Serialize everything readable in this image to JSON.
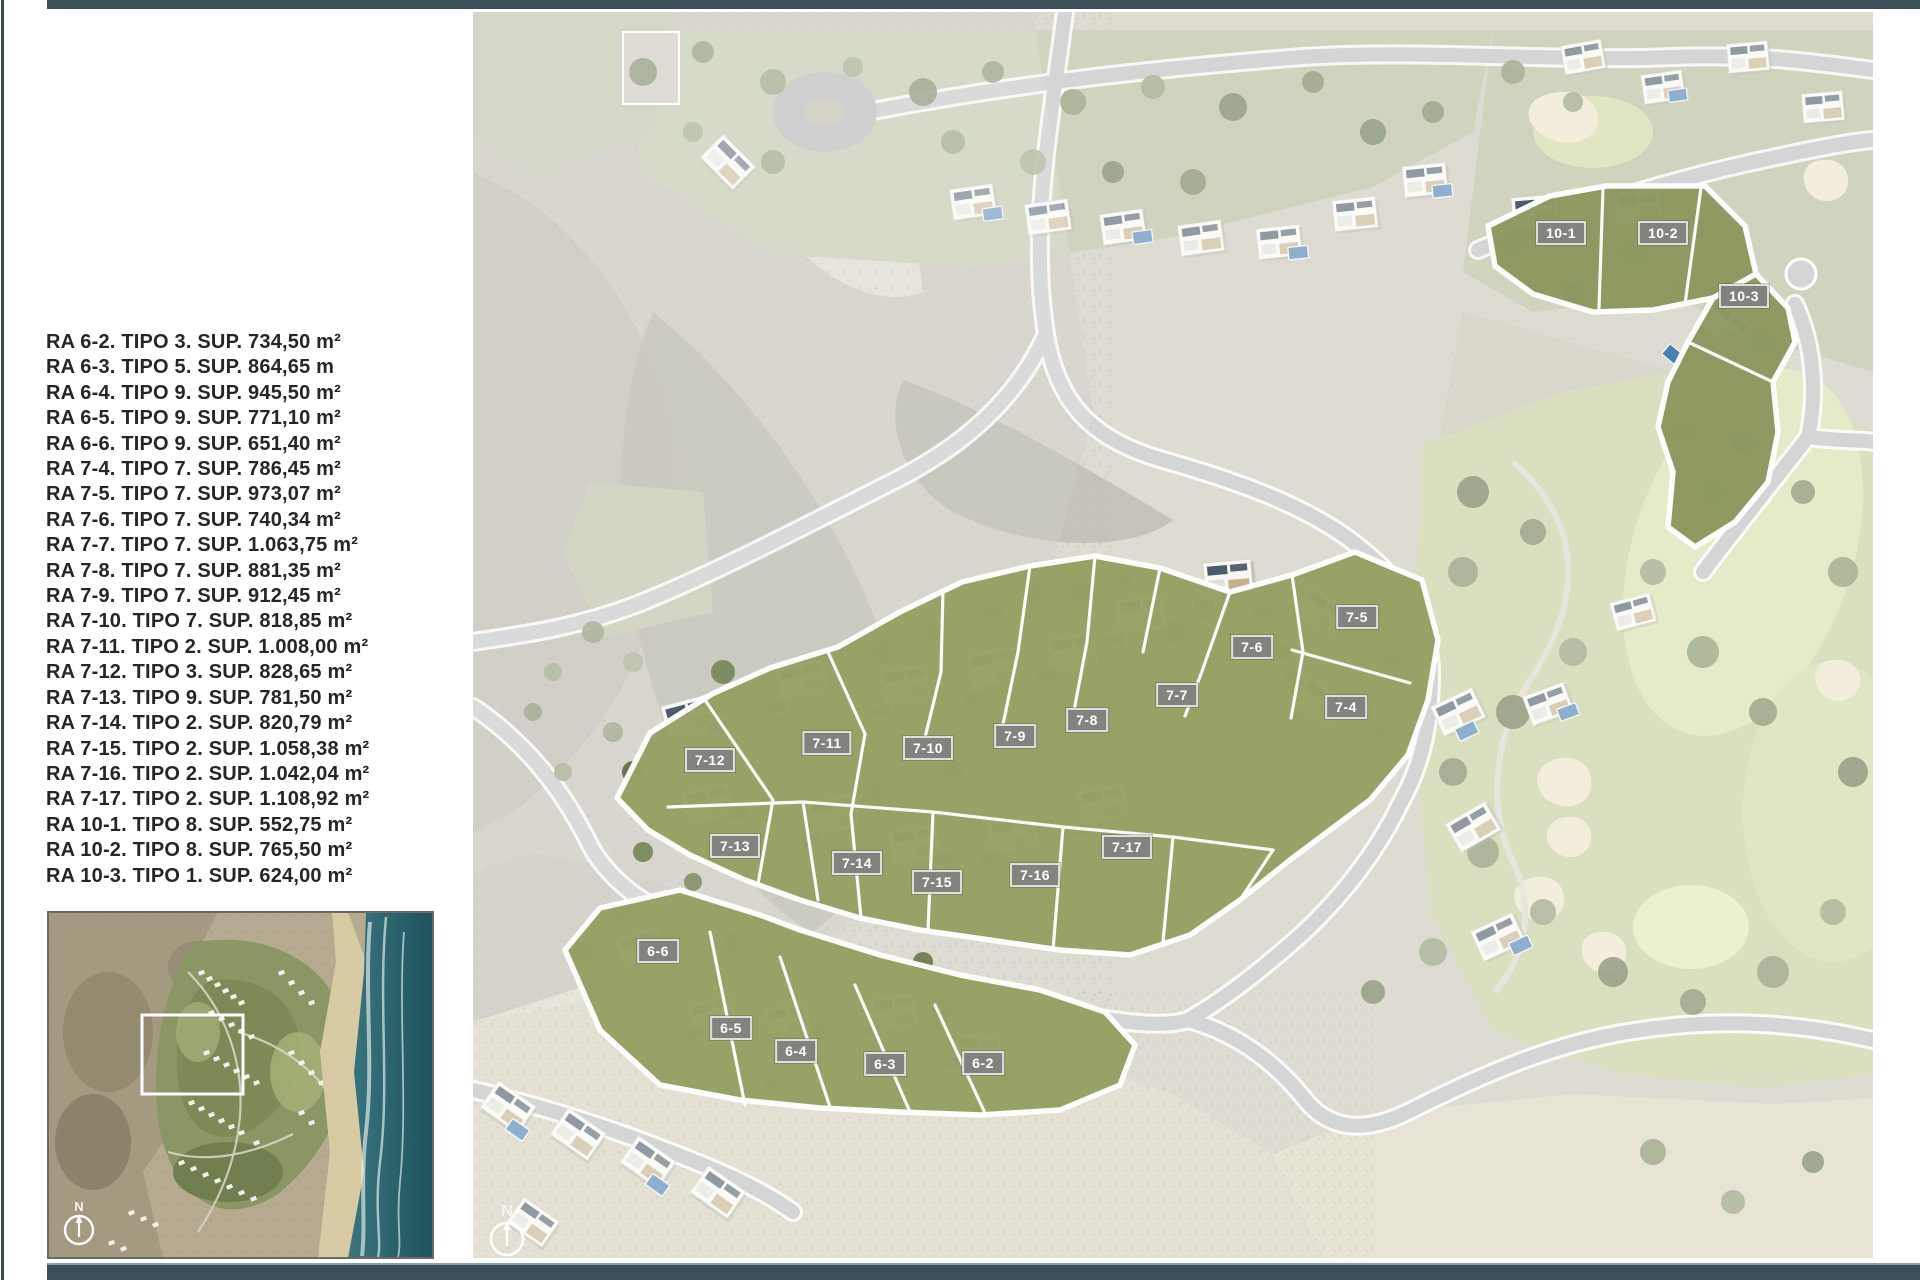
{
  "page": {
    "background": "#ffffff",
    "top_bar_color": "#3c4e58",
    "bottom_bar_color": "#3c4e58",
    "left_rule_color": "#3f4a50"
  },
  "plot_list": {
    "text_color": "#262626",
    "items": [
      {
        "ra": "RA 6-2",
        "tipo": "TIPO 3",
        "sup": "734,50 m²",
        "text": "RA 6-2. TIPO 3. SUP. 734,50 m²"
      },
      {
        "ra": "RA 6-3",
        "tipo": "TIPO 5",
        "sup": "864,65 m",
        "text": "RA 6-3. TIPO 5. SUP. 864,65 m"
      },
      {
        "ra": "RA 6-4",
        "tipo": "TIPO 9",
        "sup": "945,50 m²",
        "text": "RA 6-4. TIPO 9. SUP. 945,50 m²"
      },
      {
        "ra": "RA 6-5",
        "tipo": "TIPO 9",
        "sup": "771,10 m²",
        "text": "RA 6-5. TIPO 9. SUP. 771,10 m²"
      },
      {
        "ra": "RA 6-6",
        "tipo": "TIPO 9",
        "sup": "651,40 m²",
        "text": "RA 6-6. TIPO 9. SUP. 651,40 m²"
      },
      {
        "ra": "RA 7-4",
        "tipo": "TIPO 7",
        "sup": "786,45 m²",
        "text": "RA 7-4. TIPO 7. SUP. 786,45 m²"
      },
      {
        "ra": "RA 7-5",
        "tipo": "TIPO 7",
        "sup": "973,07 m²",
        "text": "RA 7-5. TIPO 7. SUP. 973,07 m²"
      },
      {
        "ra": "RA 7-6",
        "tipo": "TIPO 7",
        "sup": "740,34 m²",
        "text": "RA 7-6. TIPO 7. SUP. 740,34 m²"
      },
      {
        "ra": "RA 7-7",
        "tipo": "TIPO 7",
        "sup": "1.063,75 m²",
        "text": "RA 7-7. TIPO 7. SUP. 1.063,75 m²"
      },
      {
        "ra": "RA 7-8",
        "tipo": "TIPO 7",
        "sup": "881,35 m²",
        "text": "RA 7-8. TIPO 7. SUP. 881,35 m²"
      },
      {
        "ra": "RA 7-9",
        "tipo": "TIPO 7",
        "sup": "912,45 m²",
        "text": "RA 7-9. TIPO 7. SUP. 912,45 m²"
      },
      {
        "ra": "RA 7-10",
        "tipo": "TIPO 7",
        "sup": "818,85 m²",
        "text": "RA 7-10. TIPO 7. SUP. 818,85 m²"
      },
      {
        "ra": "RA 7-11",
        "tipo": "TIPO 2",
        "sup": "1.008,00 m²",
        "text": "RA 7-11. TIPO 2. SUP. 1.008,00 m²"
      },
      {
        "ra": "RA 7-12",
        "tipo": "TIPO 3",
        "sup": "828,65 m²",
        "text": "RA 7-12. TIPO 3. SUP. 828,65 m²"
      },
      {
        "ra": "RA 7-13",
        "tipo": "TIPO 9",
        "sup": "781,50 m²",
        "text": "RA 7-13. TIPO 9. SUP. 781,50 m²"
      },
      {
        "ra": "RA 7-14",
        "tipo": "TIPO 2",
        "sup": "820,79 m²",
        "text": "RA 7-14. TIPO 2. SUP. 820,79 m²"
      },
      {
        "ra": "RA 7-15",
        "tipo": "TIPO 2",
        "sup": "1.058,38 m²",
        "text": "RA 7-15. TIPO 2. SUP. 1.058,38 m²"
      },
      {
        "ra": "RA 7-16",
        "tipo": "TIPO 2",
        "sup": "1.042,04 m²",
        "text": "RA 7-16. TIPO 2. SUP. 1.042,04 m²"
      },
      {
        "ra": "RA 7-17",
        "tipo": "TIPO 2",
        "sup": "1.108,92 m²",
        "text": "RA 7-17. TIPO 2. SUP. 1.108,92 m²"
      },
      {
        "ra": "RA 10-1",
        "tipo": "TIPO 8",
        "sup": "552,75 m²",
        "text": "RA 10-1. TIPO 8. SUP. 552,75 m²"
      },
      {
        "ra": "RA 10-2",
        "tipo": "TIPO 8",
        "sup": "765,50 m²",
        "text": "RA 10-2. TIPO 8. SUP. 765,50 m²"
      },
      {
        "ra": "RA 10-3",
        "tipo": "TIPO 1",
        "sup": "624,00 m²",
        "text": "RA 10-3. TIPO 1. SUP. 624,00 m²"
      }
    ]
  },
  "map": {
    "north_label": "N",
    "label_chip": {
      "bg": "#82827e",
      "border": "#dededa",
      "text_color": "#ffffff"
    },
    "plot_labels": [
      {
        "id": "10-1",
        "x": 1088,
        "y": 221
      },
      {
        "id": "10-2",
        "x": 1190,
        "y": 221
      },
      {
        "id": "10-3",
        "x": 1271,
        "y": 284
      },
      {
        "id": "7-5",
        "x": 884,
        "y": 605
      },
      {
        "id": "7-6",
        "x": 779,
        "y": 635
      },
      {
        "id": "7-7",
        "x": 704,
        "y": 683
      },
      {
        "id": "7-4",
        "x": 873,
        "y": 695
      },
      {
        "id": "7-8",
        "x": 614,
        "y": 708
      },
      {
        "id": "7-9",
        "x": 542,
        "y": 724
      },
      {
        "id": "7-10",
        "x": 455,
        "y": 736
      },
      {
        "id": "7-11",
        "x": 354,
        "y": 731
      },
      {
        "id": "7-12",
        "x": 237,
        "y": 748
      },
      {
        "id": "7-13",
        "x": 262,
        "y": 834
      },
      {
        "id": "7-14",
        "x": 384,
        "y": 851
      },
      {
        "id": "7-15",
        "x": 464,
        "y": 870
      },
      {
        "id": "7-16",
        "x": 562,
        "y": 863
      },
      {
        "id": "7-17",
        "x": 654,
        "y": 835
      },
      {
        "id": "6-6",
        "x": 185,
        "y": 939
      },
      {
        "id": "6-5",
        "x": 258,
        "y": 1016
      },
      {
        "id": "6-4",
        "x": 323,
        "y": 1039
      },
      {
        "id": "6-3",
        "x": 412,
        "y": 1052
      },
      {
        "id": "6-2",
        "x": 510,
        "y": 1051
      }
    ]
  },
  "inset": {
    "north_label": "N"
  }
}
